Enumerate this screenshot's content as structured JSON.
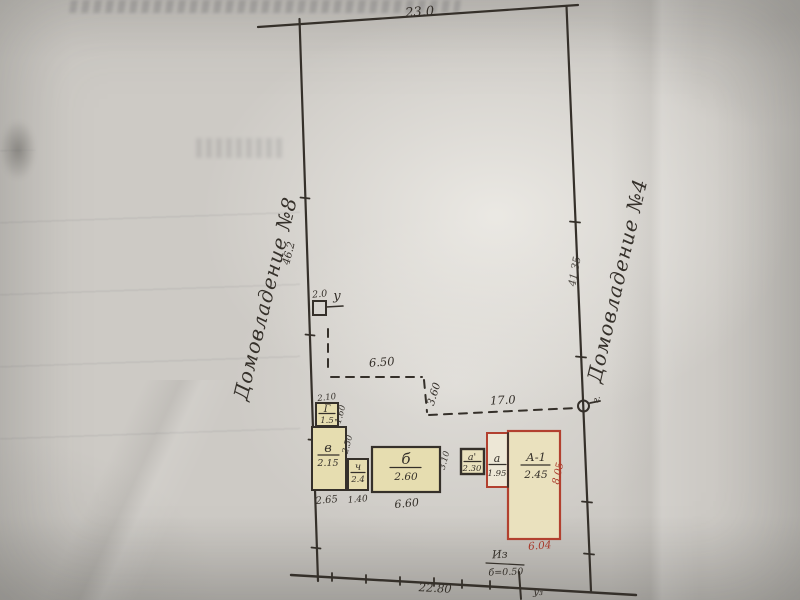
{
  "plan": {
    "neighbors": {
      "left": "Домовладение №8",
      "right": "Домовладение №4"
    },
    "boundary": {
      "top": "23.0",
      "bottom": "22.80",
      "left": "46.2",
      "right": "41.35"
    },
    "fences": {
      "seg1": "6.50",
      "seg2": "3.60",
      "seg3": "17.0"
    },
    "well": {
      "offset": "2.0",
      "mark": "у"
    },
    "gate_mark": "г.",
    "notes": {
      "iz": "Из",
      "iz_value": "б=0.50",
      "u3": "у₃"
    },
    "buildings": {
      "g": {
        "label": "Г",
        "height": "1.5",
        "width": "2.10",
        "depth": "1.60"
      },
      "v": {
        "label": "в",
        "height": "2.15",
        "width": "2.65",
        "depth": "2.50"
      },
      "ch": {
        "label": "ч",
        "height": "2.4",
        "width": "1.40"
      },
      "b": {
        "label": "б",
        "height": "2.60",
        "width": "6.60",
        "depth": "3.10"
      },
      "a2": {
        "label": "а'",
        "height": "2.30"
      },
      "a": {
        "label": "а",
        "height": "1.95"
      },
      "a1": {
        "label": "А-1",
        "height": "2.45",
        "width": "6.04",
        "depth": "8.05"
      }
    },
    "colors": {
      "ink": "#35302a",
      "red": "#b2402f",
      "building_fill": "#e6ddb0",
      "paper": "#cdcac5"
    }
  }
}
